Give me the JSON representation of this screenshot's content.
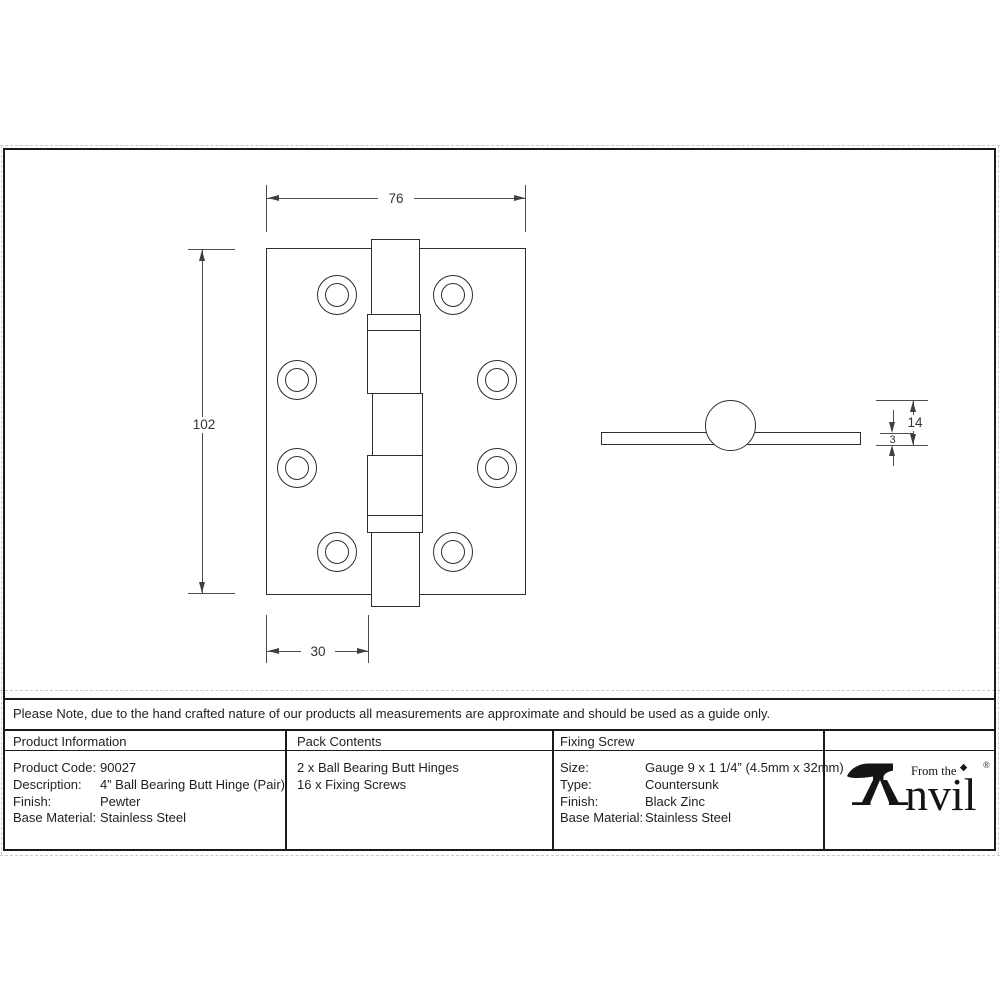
{
  "sheet": {
    "note": "Please Note, due to the hand crafted nature of our products all measurements are approximate and should be used as a guide only.",
    "drawing": {
      "front_view": {
        "width_mm": "76",
        "height_mm": "102",
        "knuckle_offset_mm": "30"
      },
      "side_view": {
        "knuckle_diameter_mm": "14",
        "leaf_thickness_mm": "3"
      }
    },
    "table": {
      "headers": {
        "product": "Product Information",
        "pack": "Pack Contents",
        "screw": "Fixing Screw"
      },
      "product_info": [
        {
          "label": "Product Code:",
          "value": "90027"
        },
        {
          "label": "Description:",
          "value": "4” Ball Bearing Butt Hinge (Pair)"
        },
        {
          "label": "Finish:",
          "value": "Pewter"
        },
        {
          "label": "Base Material:",
          "value": "Stainless Steel"
        }
      ],
      "pack_contents": [
        "2 x Ball Bearing Butt Hinges",
        "16 x Fixing Screws"
      ],
      "fixing_screw": [
        {
          "label": "Size:",
          "value": "Gauge 9 x 1 1/4” (4.5mm x 32mm)"
        },
        {
          "label": "Type:",
          "value": "Countersunk"
        },
        {
          "label": "Finish:",
          "value": "Black Zinc"
        },
        {
          "label": "Base Material:",
          "value": "Stainless Steel"
        }
      ]
    },
    "logo": {
      "prefix": "From the",
      "brand_rest": "nvil",
      "registered": "®"
    },
    "colors": {
      "ink": "#1a1a1a",
      "dimension": "#4d4d4d"
    }
  }
}
